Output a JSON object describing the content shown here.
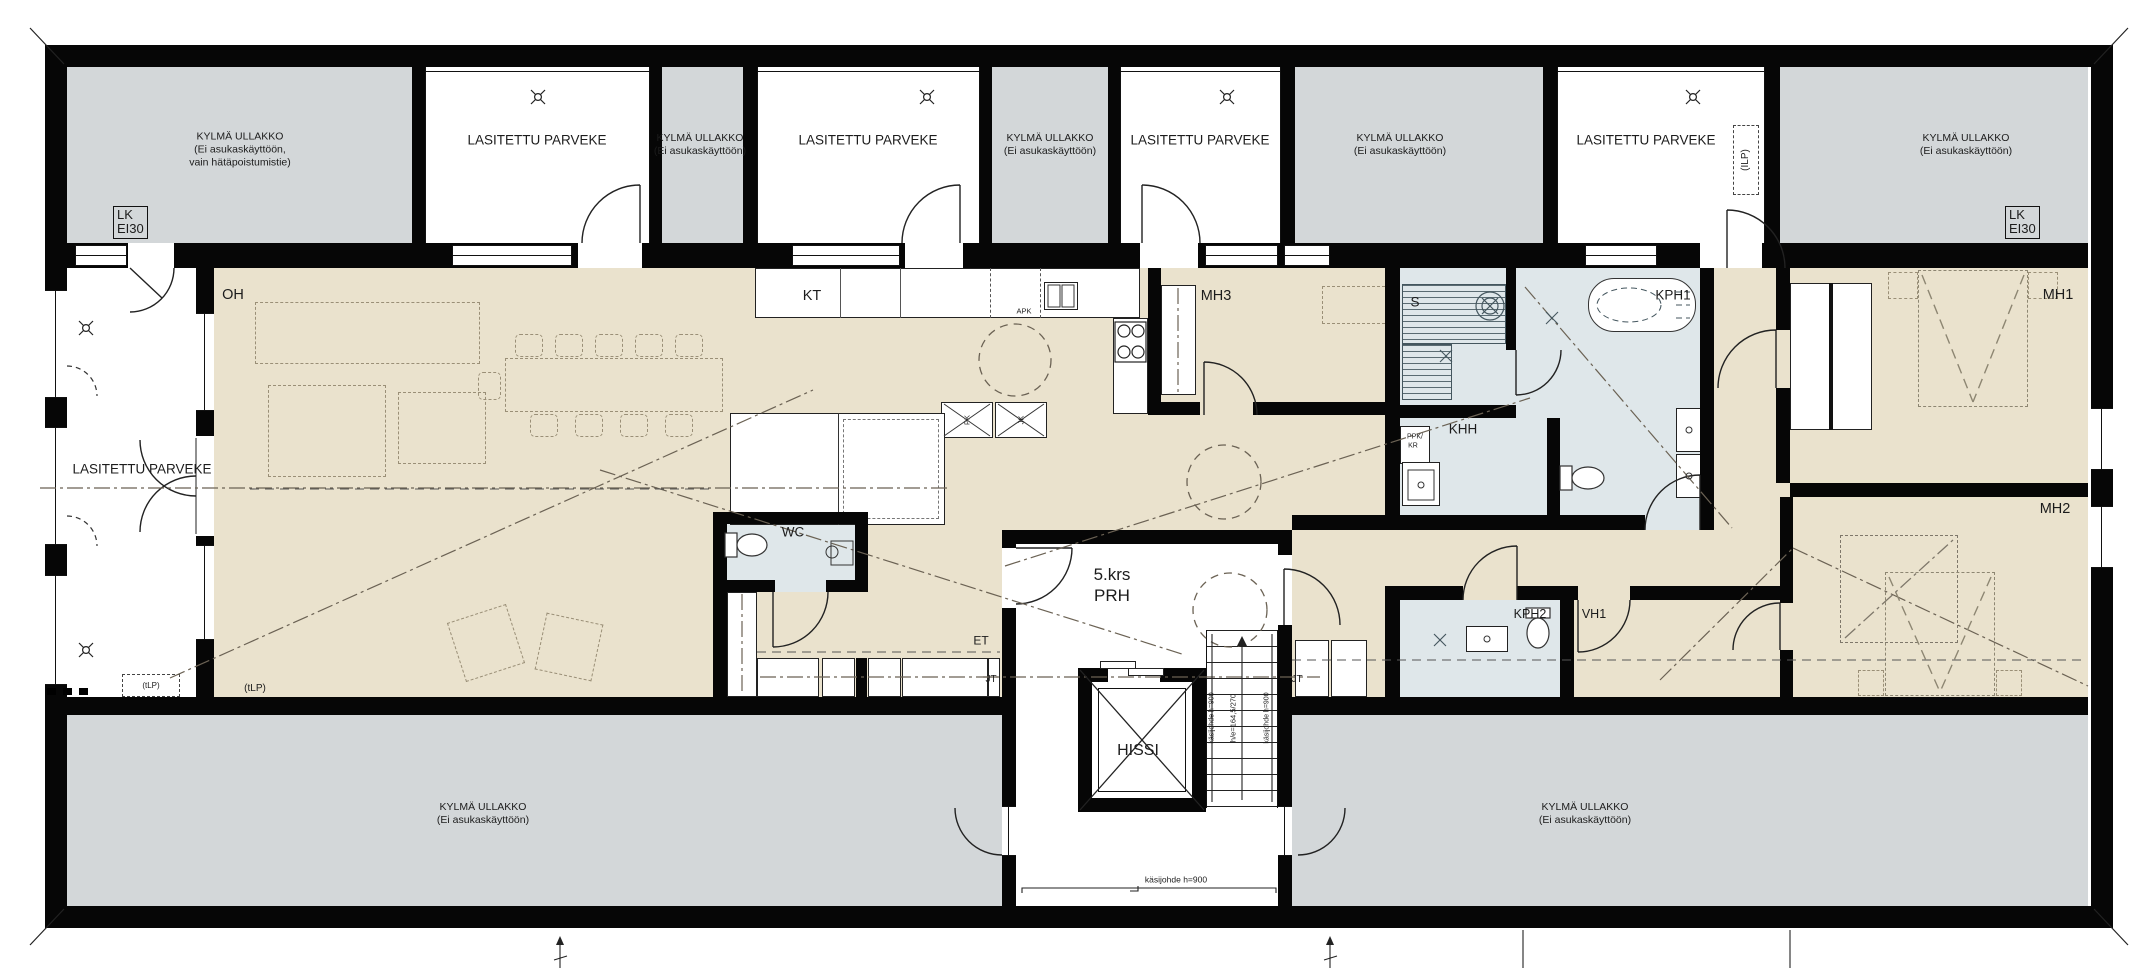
{
  "drawing": {
    "type": "architectural floor plan",
    "floor": "5.krs"
  },
  "colors": {
    "floor_beige": "#eae2cd",
    "attic_gray": "#d3d7d9",
    "wet_room_blue": "#dfe7ea",
    "wall_black": "#060606",
    "furniture_dash": "#9a8f77"
  },
  "labels": {
    "glazed_balcony": "LASITETTU PARVEKE",
    "attic_emergency": {
      "l1": "KYLMÄ ULLAKKO",
      "l2": "(Ei asukaskäyttöön,",
      "l3": "vain hätäpoistumistie)"
    },
    "attic": {
      "l1": "KYLMÄ ULLAKKO",
      "l2": "(Ei asukaskäyttöön)"
    },
    "fire_hatch": {
      "l1": "LK",
      "l2": "EI30"
    },
    "ilp": "(ILP)",
    "tlp": "(tLP)",
    "rooms": {
      "oh": "OH",
      "kt": "KT",
      "mh1": "MH1",
      "mh2": "MH2",
      "mh3": "MH3",
      "wc": "WC",
      "et": "ET",
      "sauna": "S",
      "kph1": "KPH1",
      "kph2": "KPH2",
      "khh": "KHH",
      "vh1": "VH1",
      "hissi": "HISSI",
      "floor_no": "5.krs",
      "stairwell": "PRH"
    },
    "appliances": {
      "apk": "APK",
      "pk": "PK",
      "jk": "JK",
      "ppk": "PPK/",
      "kr": "KR",
      "jt": "JT"
    },
    "stairs": {
      "handrail": "käsijohde h=900",
      "riser": "h/e=164,5/270"
    }
  }
}
